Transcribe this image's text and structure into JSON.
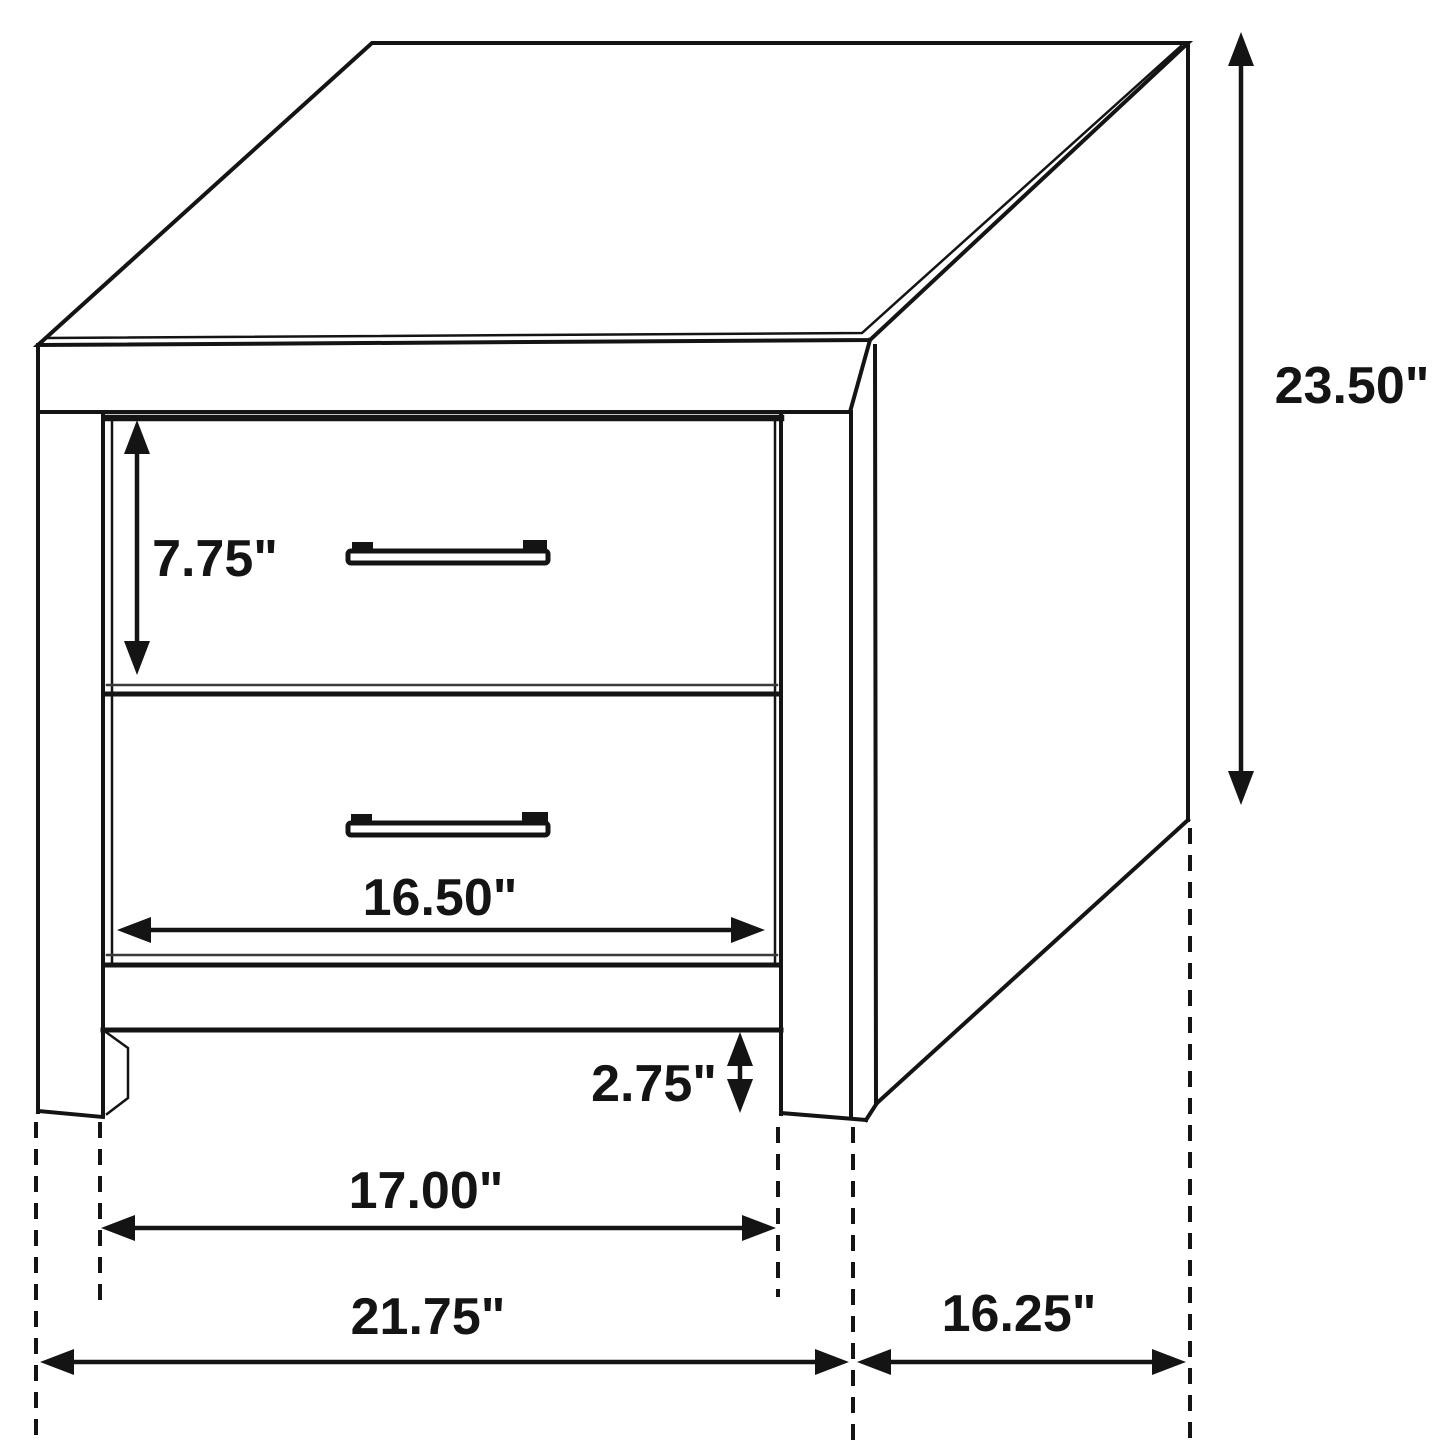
{
  "meta": {
    "background_color": "#ffffff",
    "ink_color": "#141414",
    "canvas_width": 1445,
    "canvas_height": 1445
  },
  "diagram": {
    "type": "furniture-dimension-drawing",
    "subject": "Two-drawer nightstand, three-quarter isometric line drawing with dimension arrows",
    "units": "inches",
    "dimensions": {
      "drawer_front_height": "7.75\"",
      "overall_height": "23.50\"",
      "drawer_width": "16.50\"",
      "leg_clearance_height": "2.75\"",
      "inner_leg_span_width": "17.00\"",
      "overall_width": "21.75\"",
      "overall_depth": "16.25\""
    }
  }
}
